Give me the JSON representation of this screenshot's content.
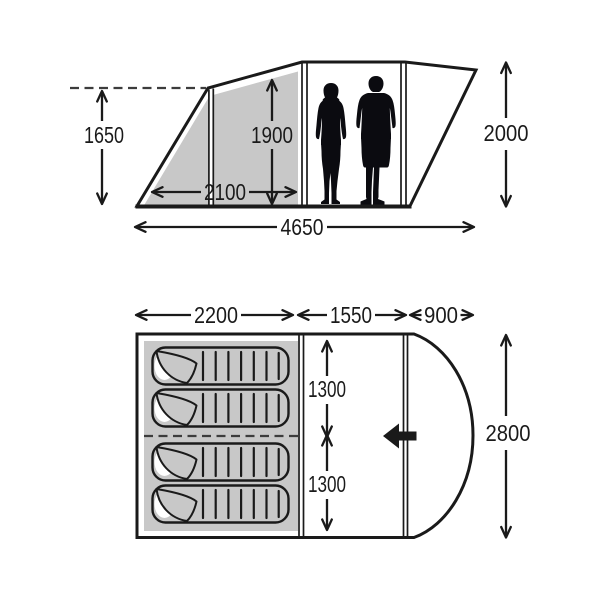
{
  "diagram": {
    "type": "tent-dimension-spec",
    "colors": {
      "line": "#1a1a1a",
      "shade": "#c8c8c8",
      "dash_line": "#3c3c3c",
      "figure": "#0b0b10",
      "background": "#ffffff"
    },
    "side_view": {
      "dim_front_pole_height": "1650",
      "dim_interior_height": "1900",
      "dim_front_section_depth": "2100",
      "dim_total_length": "4650",
      "dim_rear_height": "2000",
      "icons": [
        "woman-silhouette",
        "man-silhouette"
      ]
    },
    "floor_plan": {
      "dim_bedroom_length": "2200",
      "dim_living_length": "1550",
      "dim_porch_length": "900",
      "dim_bedroom_half_top": "1300",
      "dim_bedroom_half_bottom": "1300",
      "dim_total_width": "2800",
      "sleeping_bag_count": 4,
      "icons": [
        "sleeping-bag-top-view",
        "entrance-arrow"
      ]
    }
  }
}
